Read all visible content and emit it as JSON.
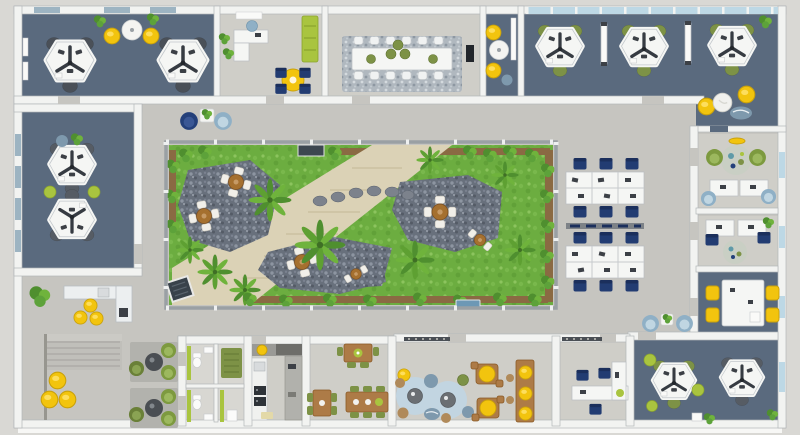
{
  "scene": {
    "type": "3d-office-floor-plan",
    "view": "top-down 3D render, no visible text labels",
    "image_size": {
      "width": 800,
      "height": 435
    }
  },
  "palette": {
    "outside": "#d9d8d4",
    "hall": "#c6c5c0",
    "room_light": "#cfcec8",
    "room_lighter": "#d8d7d2",
    "slate": "#5a6a7e",
    "wall": "#f2f3f1",
    "wall_shadow": "#b2b6b8",
    "glass": "#bdd8e5",
    "window_dark": "#9db4c2",
    "desk": "#f5f6f4",
    "chair_navy": "#223c72",
    "chair_gray": "#4a5058",
    "olive": "#7d9246",
    "lime": "#a9c43f",
    "yellow": "#f2c40e",
    "wood": "#ad7b47",
    "wood_dark": "#8a5a26",
    "grass": "#6cad40",
    "grass_light": "#85bf55",
    "soil": "#8a6a43",
    "stone": "#68707c",
    "stone_light": "#939aa6",
    "gravel": "#dbd2b6",
    "rug_blue": "#c2d5e1",
    "rug_gray": "#b2b2ad",
    "pouf_blue": "#7e99ad",
    "green_dark": "#4f8f2f",
    "green_mid": "#6fb33c",
    "dark": "#3a3f46",
    "white": "#f4f4f2"
  },
  "rooms": [
    {
      "id": "team-office-top-left",
      "floor": "slate",
      "workstation_clusters": 2,
      "extras": "2 yellow lounge chairs + round white table + plants"
    },
    {
      "id": "private-office-top",
      "floor": "room_light",
      "extras": "L-desk, blue task chair, lime bench, yellow bistro table with 4 navy chairs"
    },
    {
      "id": "conference-room",
      "floor": "room_light",
      "extras": "12-seat white table, 5 green poufs, wall TV, mottled rug"
    },
    {
      "id": "lounge-nook-top",
      "floor": "slate",
      "extras": "2 yellow bean bags, round white table, blue pouf, shelf"
    },
    {
      "id": "open-office-top-right",
      "floor": "slate",
      "workstation_clusters": 3,
      "extras": "2 divider screens, window band, bean-bag corner (2 yellow, 1 white, 1 blue)"
    },
    {
      "id": "team-office-left",
      "floor": "slate",
      "workstation_clusters": 2,
      "extras": "2 lime poufs, center plant, blue pouf"
    },
    {
      "id": "office-right-a",
      "floor": "room_light",
      "extras": "2 facing desks, blue chairs, 2 green armchairs, round patterned rug"
    },
    {
      "id": "office-right-b",
      "floor": "room_light",
      "extras": "2 facing desks, navy chairs, round patterned rug, plant"
    },
    {
      "id": "meeting-room-right",
      "floor": "slate",
      "extras": "white table with 4 yellow chairs"
    },
    {
      "id": "team-office-bottom-right",
      "floor": "slate",
      "workstation_clusters": 2,
      "extras": "lime poufs, plants, bin"
    },
    {
      "id": "office-bottom-small",
      "floor": "room_light",
      "extras": "white L-desk, 3 navy chairs, plant"
    },
    {
      "id": "cafe-lounge",
      "floor": "room_light",
      "extras": "2 round blue rugs with poufs, 2 wood tables with yellow tops, wood bar with 3 yellow stools, coat racks"
    },
    {
      "id": "dining-room",
      "floor": "room_light",
      "extras": "3 wood tables, green chairs and poufs"
    },
    {
      "id": "kitchen",
      "floor": "room_light",
      "extras": "galley counters, sink, stacked ovens, tiled worktop"
    },
    {
      "id": "restrooms",
      "floor": "room_lighter",
      "extras": "2 WCs with green accent walls, green mat room"
    },
    {
      "id": "atrium-courtyard",
      "floor": "grass",
      "extras": "glass walls, palms, shrubs, soil borders, diagonal gravel path, stepping stones, 2 stone patios, 6 garden tables with cream chairs, planter, floor grate, blue doormat"
    },
    {
      "id": "open-hall",
      "floor": "hall",
      "extras": "reception pair of armchairs with plant table, 2 desk rows (6 navy seats each) with storage rail, stairs, 3 yellow bean bags, coffee counter with 3 yellow stools, 2 lounge rugs with round tables and olive chairs, blue armchair nook"
    }
  ],
  "open_plan_desks": {
    "blocks": 2,
    "seats_per_block": 6,
    "chair_color": "chair_navy"
  },
  "counts": {
    "pinwheel_workstation_clusters": 9,
    "garden_tables": 6,
    "yellow_seats": 17,
    "palms": 9
  }
}
